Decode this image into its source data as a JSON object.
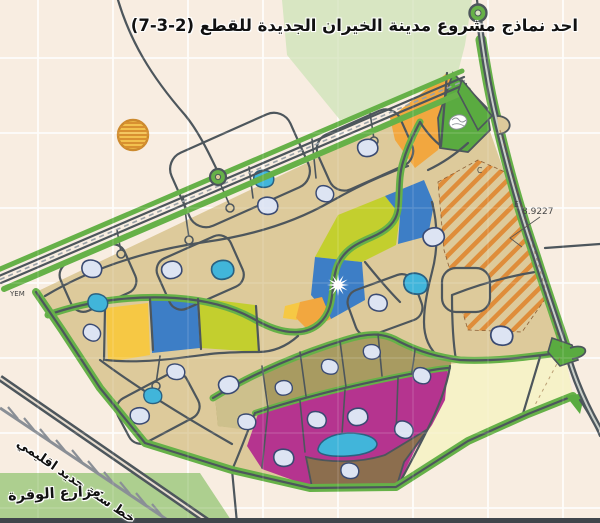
{
  "title": "احد نماذج مشروع مدينة الخيران الجديدة للقطع (2-3-7)",
  "annotations": {
    "railway_label": "خط سكة حديد اقليمي",
    "farms_label": "مزارع الوفرة",
    "elevation_value": "8.9227",
    "corner_mark": "YEM",
    "zone_letter_e": "E",
    "zone_letter_c": "C"
  },
  "symbols": {
    "star_symbol": "12-point white starburst on blue parcel",
    "hatched_circle": "orange hatched circle landmark",
    "park_scribble": "white scribble emblem on green park",
    "railway": "gray line with perpendicular tick marks"
  },
  "colors": {
    "background": "#f8ede1",
    "residential_tan": "#ddca9b",
    "suburban_khaki": "#a89b61",
    "khaki_light": "#cdc08c",
    "commercial_magenta": "#b5348f",
    "brown_parcel": "#8c6e4e",
    "reserve_cream": "#f6f2c8",
    "orange_parcel": "#f2a73f",
    "yellow_parcel": "#f6c844",
    "lime_parcel": "#c3cf2e",
    "blue_parcel": "#3d7ec6",
    "cyan_parcel": "#41b5da",
    "pond_fill": "#dde4f3",
    "pond_outline": "#3a4a72",
    "green_buffer": "#66b148",
    "pale_green_zone": "#d8e6c2",
    "farm_green": "#adcf8f",
    "road_dark": "#4d565c",
    "hatch_orange": "#e08a35",
    "grid_line": "#ffffff"
  }
}
